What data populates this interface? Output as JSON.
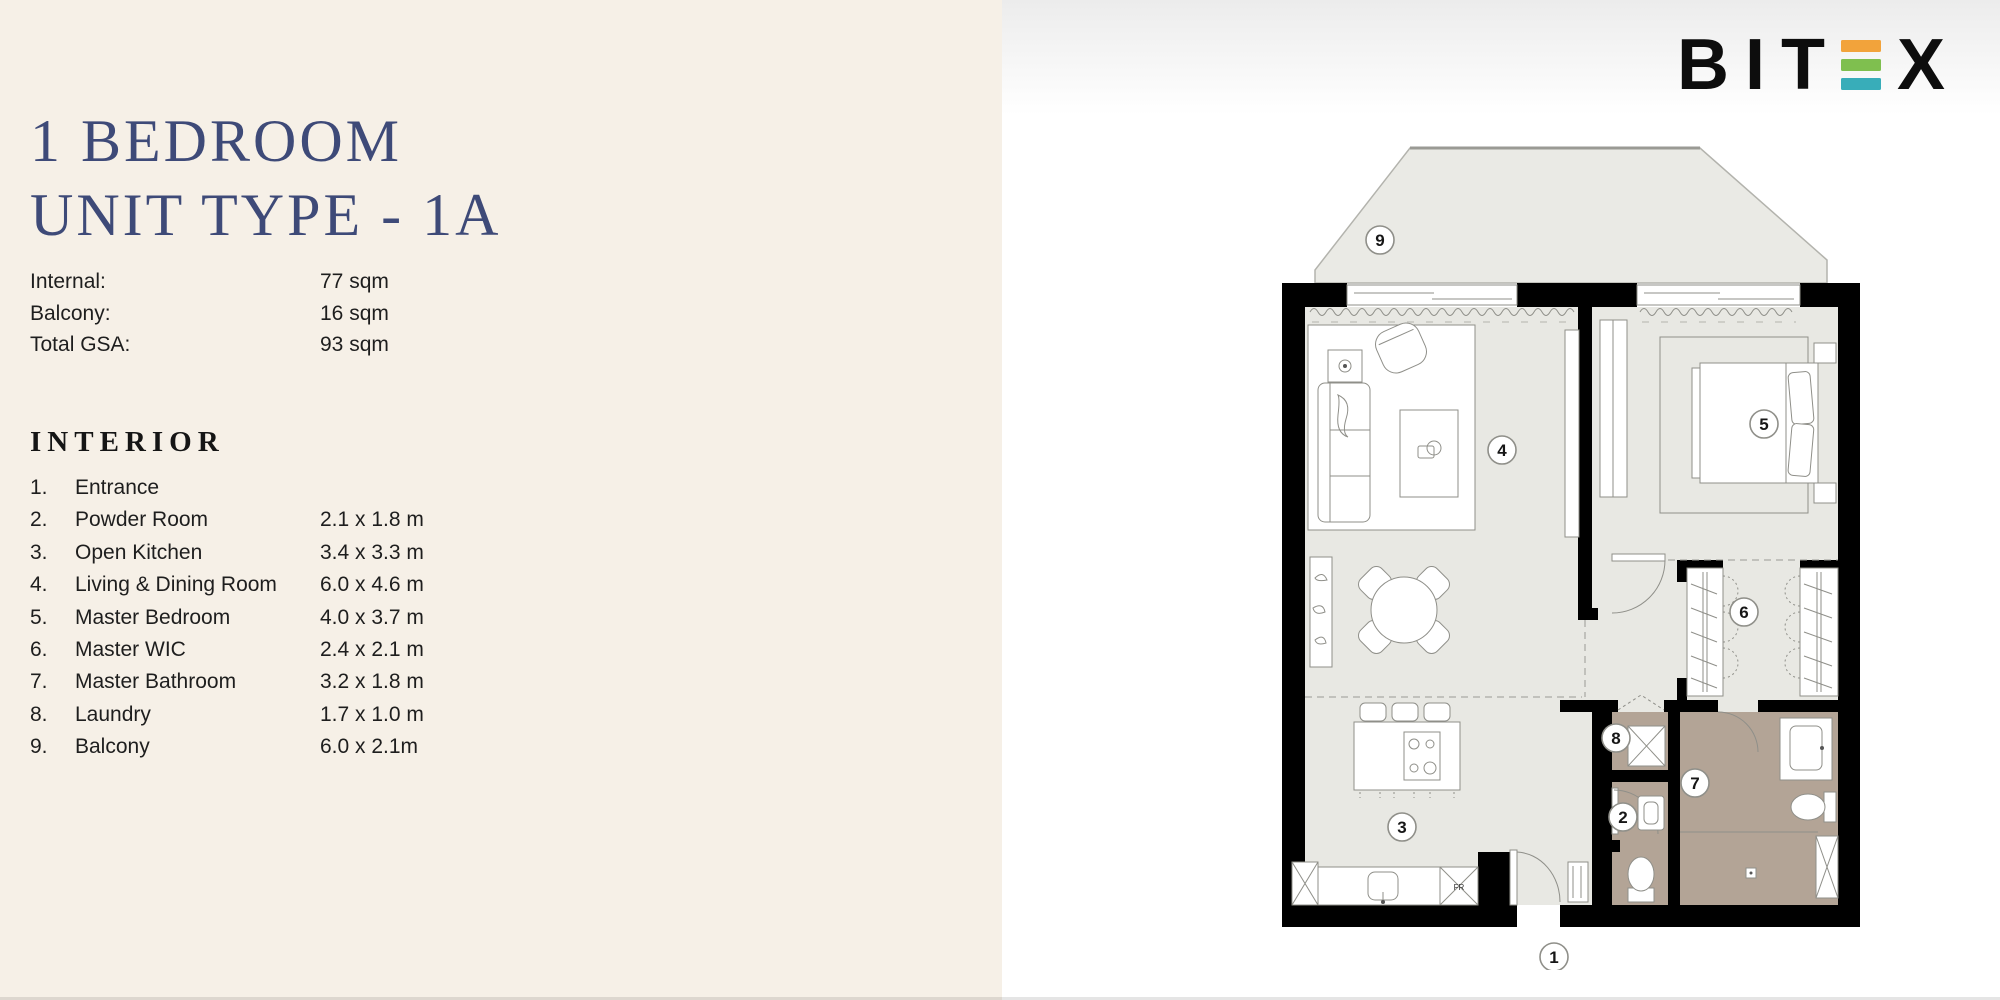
{
  "palette": {
    "beige": "#f6f0e7",
    "title_navy": "#3e4a78",
    "floor": "#e8e8e3",
    "wet_floor": "#b3a496",
    "balcony_floor": "#eaeae5",
    "wall": "#000000"
  },
  "header": {
    "title_line1": "1 BEDROOM",
    "title_line2": "UNIT TYPE - 1A"
  },
  "specs": {
    "rows": [
      {
        "label": "Internal:",
        "value": "77 sqm"
      },
      {
        "label": "Balcony:",
        "value": "16 sqm"
      },
      {
        "label": "Total GSA:",
        "value": "93 sqm"
      }
    ]
  },
  "interior": {
    "heading": "INTERIOR",
    "items": [
      {
        "num": "1.",
        "name": "Entrance",
        "size": ""
      },
      {
        "num": "2.",
        "name": "Powder Room",
        "size": "2.1 x 1.8 m"
      },
      {
        "num": "3.",
        "name": "Open Kitchen",
        "size": "3.4 x 3.3 m"
      },
      {
        "num": "4.",
        "name": "Living & Dining Room",
        "size": "6.0 x 4.6 m"
      },
      {
        "num": "5.",
        "name": "Master Bedroom",
        "size": "4.0 x 3.7 m"
      },
      {
        "num": "6.",
        "name": "Master WIC",
        "size": "2.4 x 2.1 m"
      },
      {
        "num": "7.",
        "name": "Master Bathroom",
        "size": "3.2 x 1.8 m"
      },
      {
        "num": "8.",
        "name": "Laundry",
        "size": "1.7 x 1.0 m"
      },
      {
        "num": "9.",
        "name": "Balcony",
        "size": "6.0 x 2.1m"
      }
    ]
  },
  "logo": {
    "letters": [
      "B",
      "I",
      "T"
    ],
    "last_letter": "X",
    "bar_colors": [
      "#F2A33B",
      "#7FBF4F",
      "#38ADB9"
    ]
  },
  "plan": {
    "markers": [
      "1",
      "2",
      "3",
      "4",
      "5",
      "6",
      "7",
      "8",
      "9"
    ],
    "fridge_label": "FR"
  }
}
